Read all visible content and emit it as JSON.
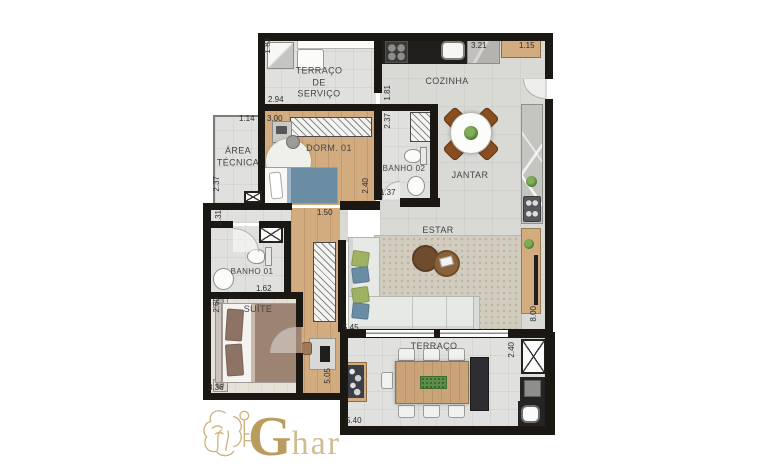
{
  "rooms": {
    "servico": "TERRAÇO\nDE\nSERVIÇO",
    "cozinha": "COZINHA",
    "area_tecnica": "ÁREA\nTÉCNICA",
    "dorm1": "DORM. 01",
    "banho2": "BANHO 02",
    "jantar": "JANTAR",
    "estar": "ESTAR",
    "banho1": "BANHO 01",
    "suite": "SUÍTE",
    "terraco": "TERRAÇO"
  },
  "dims": [
    {
      "value": "1.83"
    },
    {
      "value": "2.94"
    },
    {
      "value": "3.21"
    },
    {
      "value": "1.15"
    },
    {
      "value": "1.81"
    },
    {
      "value": "1.14"
    },
    {
      "value": "3.00"
    },
    {
      "value": "2.37"
    },
    {
      "value": "2.40"
    },
    {
      "value": "1.37"
    },
    {
      "value": "2.37"
    },
    {
      "value": "2.31"
    },
    {
      "value": "1.50"
    },
    {
      "value": "1.62"
    },
    {
      "value": "2.60"
    },
    {
      "value": "3.36"
    },
    {
      "value": "5.05"
    },
    {
      "value": "5.45"
    },
    {
      "value": "8.00"
    },
    {
      "value": "2.40"
    },
    {
      "value": "5.40"
    }
  ],
  "logo": {
    "initial": "G",
    "rest": "har"
  },
  "colors": {
    "wall": "#1b1713",
    "tile": "#d9d9d6",
    "tile2": "#e0e0de",
    "wood": "#d2ab7f",
    "rug": "#d2ccbf",
    "sofa": "#e7e9e6",
    "green": "#9fb262",
    "blue": "#6a8da4",
    "brown": "#82552f",
    "chair": "#8a4f21",
    "taupe": "#9c8372",
    "gold": "#bb9c5f",
    "gold_light": "#cfbd92"
  }
}
